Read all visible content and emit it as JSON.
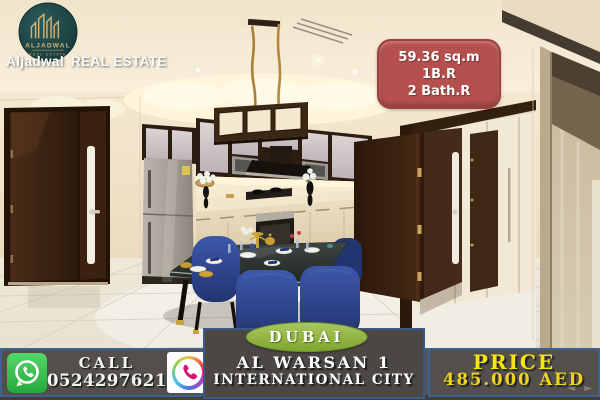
{
  "brand": {
    "logo_circle_text": "ALJADWAL",
    "logo_circle_subtext": "REAL ESTATE",
    "company_first": "Aljadwal",
    "company_second": "REAL ESTATE"
  },
  "property": {
    "area": "59.36 sq.m",
    "bedrooms": "1B.R",
    "bathrooms": "2 Bath.R"
  },
  "location": {
    "city": "DUBAI",
    "line1": "AL WARSAN 1",
    "line2": "INTERNATIONAL CITY"
  },
  "contact": {
    "call_label": "CALL",
    "phone": "0524297621",
    "whatsapp_icon": "whatsapp-icon",
    "phone_icon": "phone-icon"
  },
  "price": {
    "label": "PRICE",
    "amount": "485.000 AED"
  },
  "watermark": {
    "arrows": "◄ ►"
  },
  "colors": {
    "spec_badge_red": "#b5504e",
    "dubai_green": "#8cb141",
    "price_yellow": "#f3e512",
    "band_gray": "#56534f",
    "band_border_blue": "#3f6190",
    "whatsapp_green": "#2fbc45",
    "phone_icon_pink": "#d6156e",
    "logo_teal": "#1e4444",
    "logo_gold": "#d2b277",
    "chair_blue": "#2c4190",
    "door_brown": "#3c2412"
  }
}
